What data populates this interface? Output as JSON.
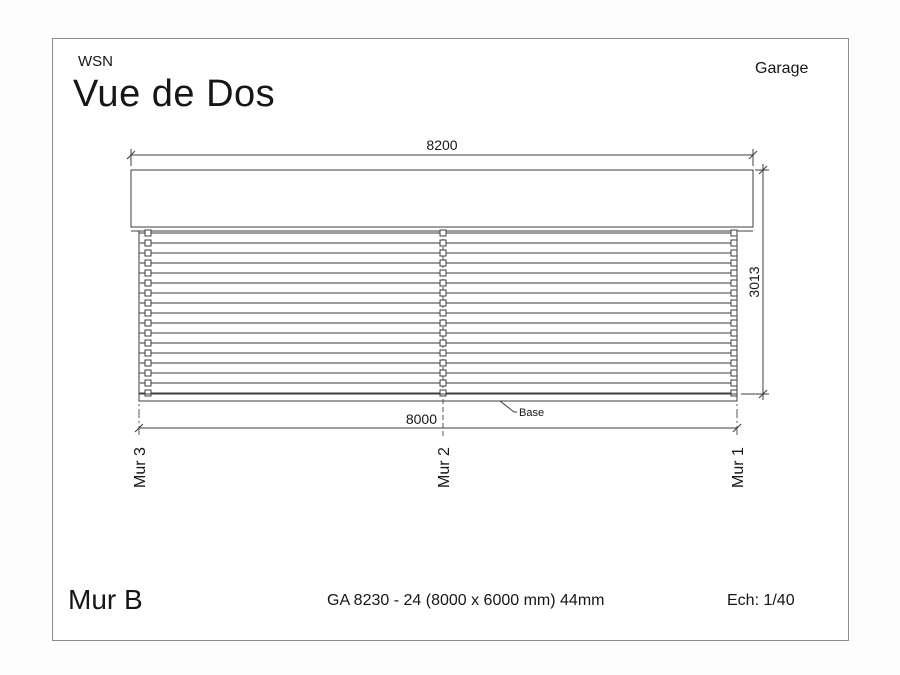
{
  "header": {
    "brand": "WSN",
    "title": "Vue de Dos",
    "project": "Garage"
  },
  "drawing": {
    "dim_top": "8200",
    "dim_right": "3013",
    "dim_bottom": "8000",
    "base_label": "Base",
    "wall_markers": [
      "Mur 3",
      "Mur 2",
      "Mur 1"
    ]
  },
  "footer": {
    "wall_name": "Mur B",
    "reference": "GA 8230 - 24 (8000 x 6000 mm) 44mm",
    "scale": "Ech: 1/40"
  },
  "colors": {
    "ink": "#161616",
    "line": "#3d3d3d",
    "frame": "#8c8c8c",
    "plank_shadow": "#9a9a9a",
    "dash": "#555555"
  }
}
